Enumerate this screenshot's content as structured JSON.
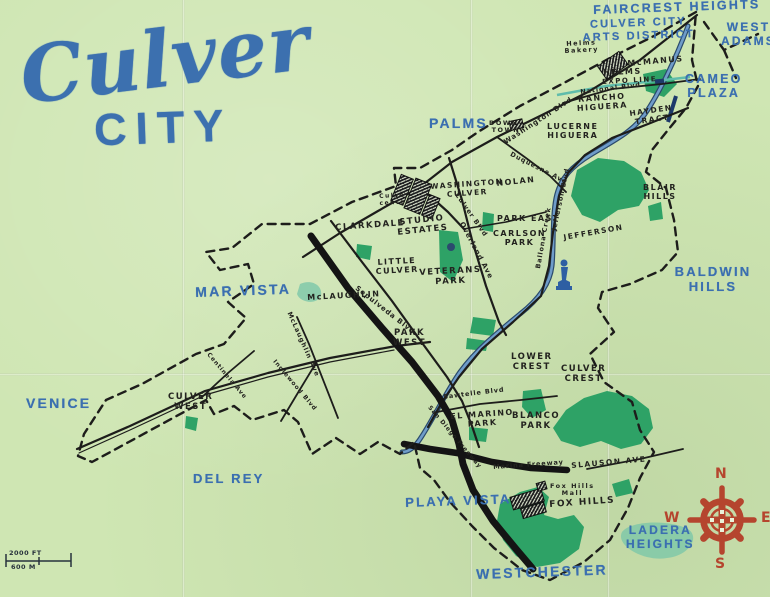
{
  "map": {
    "title": {
      "script": "Culver",
      "caps": "CITY"
    },
    "colors": {
      "paper": "#cfe6b3",
      "ink": "#23231f",
      "marker_blue": "#3b6fb0",
      "park_green": "#2ea266",
      "highlight_teal": "#7cc7a9",
      "creek_blue": "#6f9cc9",
      "creek_edge": "#2a4a6b",
      "compass_red": "#b5452e"
    },
    "region_labels": [
      {
        "name": "label-faircrest-heights",
        "text": "FAIRCREST HEIGHTS",
        "x": 593,
        "y": 3,
        "size": 12.5,
        "rot": -2
      },
      {
        "name": "label-west-adams",
        "text": "WEST\nADAMS",
        "x": 721,
        "y": 21,
        "size": 12,
        "rot": 0
      },
      {
        "name": "label-culver-city-arts-district",
        "text": "CULVER CITY\nARTS DISTRICT",
        "x": 582,
        "y": 19,
        "size": 11,
        "rot": -2
      },
      {
        "name": "label-cameo-plaza",
        "text": "CAMEO\nPLAZA",
        "x": 685,
        "y": 72,
        "size": 12.5,
        "rot": 0
      },
      {
        "name": "label-palms",
        "text": "PALMS",
        "x": 429,
        "y": 116,
        "size": 14,
        "rot": 0
      },
      {
        "name": "label-mar-vista",
        "text": "MAR VISTA",
        "x": 195,
        "y": 285,
        "size": 14,
        "rot": -2
      },
      {
        "name": "label-venice",
        "text": "VENICE",
        "x": 26,
        "y": 396,
        "size": 14,
        "rot": 0
      },
      {
        "name": "label-del-rey",
        "text": "DEL REY",
        "x": 193,
        "y": 472,
        "size": 13,
        "rot": 0
      },
      {
        "name": "label-playa-vista",
        "text": "PLAYA VISTA",
        "x": 405,
        "y": 496,
        "size": 13,
        "rot": -2
      },
      {
        "name": "label-westchester",
        "text": "WESTCHESTER",
        "x": 476,
        "y": 567,
        "size": 14,
        "rot": -2
      },
      {
        "name": "label-ladera-heights",
        "text": "LADERA\nHEIGHTS",
        "x": 626,
        "y": 524,
        "size": 12,
        "rot": 0
      },
      {
        "name": "label-baldwin-hills",
        "text": "BALDWIN HILLS",
        "x": 656,
        "y": 265,
        "size": 13,
        "rot": 0
      }
    ],
    "district_labels": [
      {
        "name": "label-helms-bakery",
        "text": "Helms\nBakery",
        "x": 564,
        "y": 41,
        "size": 6.5,
        "rot": -3
      },
      {
        "name": "label-mcmanus",
        "text": "McMANUS",
        "x": 627,
        "y": 59,
        "size": 8,
        "rot": -5
      },
      {
        "name": "label-helms",
        "text": "HELMS",
        "x": 603,
        "y": 68,
        "size": 8,
        "rot": -2
      },
      {
        "name": "label-expo-line",
        "text": "EXPO LINE",
        "x": 602,
        "y": 79,
        "size": 7,
        "rot": -3
      },
      {
        "name": "label-rancho-higuera",
        "text": "RANCHO\nHIGUERA",
        "x": 576,
        "y": 95,
        "size": 8,
        "rot": -4
      },
      {
        "name": "label-hayden-tract",
        "text": "HAYDEN\nTRACT",
        "x": 629,
        "y": 110,
        "size": 7.5,
        "rot": -8
      },
      {
        "name": "label-downtown",
        "text": "DOWN-\nTOWN",
        "x": 489,
        "y": 120,
        "size": 6.5,
        "rot": 0
      },
      {
        "name": "label-lucerne-higuera",
        "text": "LUCERNE\nHIGUERA",
        "x": 547,
        "y": 122,
        "size": 8,
        "rot": 0
      },
      {
        "name": "label-nolan",
        "text": "NOLAN",
        "x": 496,
        "y": 179,
        "size": 8,
        "rot": -6
      },
      {
        "name": "label-washington-culver",
        "text": "WASHINGTON\nCULVER",
        "x": 430,
        "y": 183,
        "size": 7.5,
        "rot": -4
      },
      {
        "name": "label-culver-center",
        "text": "Culver\ncenter",
        "x": 379,
        "y": 194,
        "size": 6,
        "rot": -3
      },
      {
        "name": "label-park-east",
        "text": "PARK EAST",
        "x": 497,
        "y": 214,
        "size": 8,
        "rot": 0
      },
      {
        "name": "label-carlson-park",
        "text": "CARLSON\nPARK",
        "x": 493,
        "y": 229,
        "size": 8,
        "rot": 0
      },
      {
        "name": "label-blair-hills",
        "text": "BLAIR\nHILLS",
        "x": 643,
        "y": 183,
        "size": 8,
        "rot": 0
      },
      {
        "name": "label-jefferson",
        "text": "JEFFERSON",
        "x": 563,
        "y": 234,
        "size": 7.5,
        "rot": -10
      },
      {
        "name": "label-clarkdale",
        "text": "CLARKDALE",
        "x": 335,
        "y": 224,
        "size": 8.5,
        "rot": -4
      },
      {
        "name": "label-studio-estates",
        "text": "STUDIO\nESTATES",
        "x": 396,
        "y": 219,
        "size": 8.5,
        "rot": -6
      },
      {
        "name": "label-little-culver",
        "text": "LITTLE\nCULVER",
        "x": 375,
        "y": 258,
        "size": 8,
        "rot": -3
      },
      {
        "name": "label-veterans-park",
        "text": "VETERANS\nPARK",
        "x": 419,
        "y": 269,
        "size": 8.5,
        "rot": -3
      },
      {
        "name": "label-mclaughlin",
        "text": "McLAUGHLIN",
        "x": 307,
        "y": 293,
        "size": 8,
        "rot": -3
      },
      {
        "name": "label-park-west",
        "text": "PARK\nWEST",
        "x": 393,
        "y": 329,
        "size": 8.5,
        "rot": 0
      },
      {
        "name": "label-culver-west",
        "text": "CULVER\nWEST",
        "x": 168,
        "y": 393,
        "size": 8.5,
        "rot": 0
      },
      {
        "name": "label-lower-crest",
        "text": "LOWER\nCREST",
        "x": 511,
        "y": 353,
        "size": 8.5,
        "rot": 0
      },
      {
        "name": "label-culver-crest",
        "text": "CULVER\nCREST",
        "x": 561,
        "y": 365,
        "size": 8.5,
        "rot": 0
      },
      {
        "name": "label-el-marino-park",
        "text": "EL MARINO\nPARK",
        "x": 450,
        "y": 412,
        "size": 8,
        "rot": -4
      },
      {
        "name": "label-blanco-park",
        "text": "BLANCO\nPARK",
        "x": 512,
        "y": 412,
        "size": 8.5,
        "rot": 0
      },
      {
        "name": "label-slauson-ave",
        "text": "SLAUSON AVE",
        "x": 571,
        "y": 462,
        "size": 7.5,
        "rot": -5
      },
      {
        "name": "label-fox-hills-mall",
        "text": "Fox Hills\nMall",
        "x": 550,
        "y": 483,
        "size": 6.5,
        "rot": 0
      },
      {
        "name": "label-fox-hills",
        "text": "FOX HILLS",
        "x": 549,
        "y": 500,
        "size": 9,
        "rot": -4
      }
    ],
    "street_labels": [
      {
        "name": "street-washington-blvd",
        "text": "Washington Blvd",
        "x": 503,
        "y": 140,
        "size": 7,
        "rot": -33
      },
      {
        "name": "street-national-blvd",
        "text": "National Blvd",
        "x": 580,
        "y": 89,
        "size": 6.5,
        "rot": -7
      },
      {
        "name": "street-duquesne-ave",
        "text": "Duquesne Ave",
        "x": 512,
        "y": 151,
        "size": 6.5,
        "rot": 27
      },
      {
        "name": "street-culver-blvd",
        "text": "Culver Blvd",
        "x": 459,
        "y": 192,
        "size": 6.5,
        "rot": 55
      },
      {
        "name": "street-overland-ave",
        "text": "Overland Ave",
        "x": 464,
        "y": 221,
        "size": 7,
        "rot": 62
      },
      {
        "name": "street-jefferson-blvd",
        "text": "Jefferson Blvd",
        "x": 551,
        "y": 230,
        "size": 6.5,
        "rot": -78
      },
      {
        "name": "street-ballona-creek",
        "text": "Ballona Creek",
        "x": 535,
        "y": 268,
        "size": 6.5,
        "rot": -80
      },
      {
        "name": "street-sepulveda-blvd",
        "text": "Sepulveda Blvd",
        "x": 358,
        "y": 285,
        "size": 7,
        "rot": 38
      },
      {
        "name": "street-mclaughlin-ave",
        "text": "McLaughlin Ave",
        "x": 292,
        "y": 311,
        "size": 6.5,
        "rot": 66
      },
      {
        "name": "street-centinela-ave",
        "text": "Centinela Ave",
        "x": 210,
        "y": 352,
        "size": 6,
        "rot": 50
      },
      {
        "name": "street-inglewood-blvd",
        "text": "Inglewood Blvd",
        "x": 276,
        "y": 359,
        "size": 6,
        "rot": 50
      },
      {
        "name": "street-sawtelle-blvd",
        "text": "Sawtelle Blvd",
        "x": 443,
        "y": 394,
        "size": 6.5,
        "rot": -7
      },
      {
        "name": "street-san-diego-freeway",
        "text": "San Diego Freeway",
        "x": 431,
        "y": 405,
        "size": 6,
        "rot": 50
      },
      {
        "name": "street-marina-freeway",
        "text": "Marina Freeway",
        "x": 493,
        "y": 464,
        "size": 6.5,
        "rot": -4
      }
    ],
    "compass": {
      "n": "N",
      "e": "E",
      "s": "S",
      "w": "W"
    },
    "scale": {
      "feet": "2000 FT",
      "meters": "600 M"
    }
  }
}
